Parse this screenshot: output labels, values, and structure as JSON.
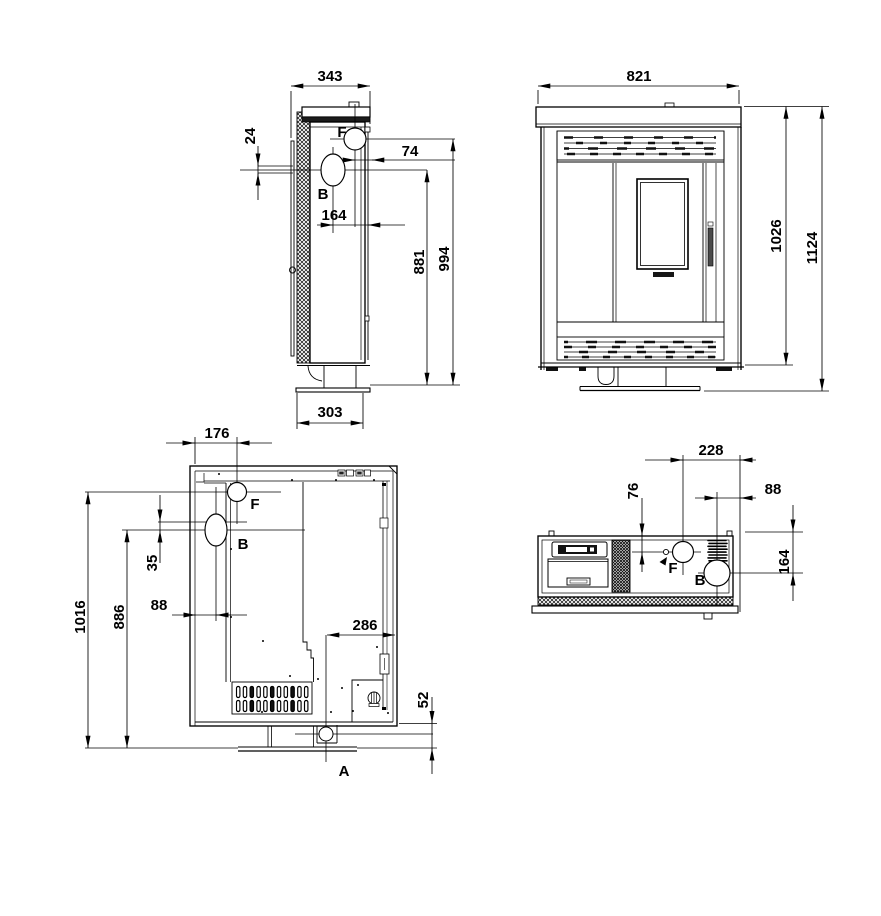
{
  "drawing": {
    "type": "stove-dimension-drawing",
    "views": {
      "side": {
        "dims": {
          "depth": "343",
          "back_offset": "24",
          "f_to_front": "74",
          "b_to_front": "164",
          "b_height": "881",
          "f_height": "994",
          "base_depth": "303"
        },
        "ports": {
          "f": "F",
          "b": "B"
        }
      },
      "front": {
        "dims": {
          "width": "821",
          "body_height": "1026",
          "total_height": "1124"
        }
      },
      "section": {
        "dims": {
          "f_offset": "176",
          "fb_gap": "35",
          "b_offset": "88",
          "f_height": "1016",
          "b_height": "886",
          "a_offset": "286",
          "a_height": "52"
        },
        "ports": {
          "f": "F",
          "b": "B",
          "a": "A"
        }
      },
      "top": {
        "dims": {
          "f_to_back": "228",
          "b_to_back": "88",
          "f_depth": "76",
          "b_depth": "164"
        },
        "ports": {
          "f": "F",
          "b": "B"
        }
      }
    },
    "colors": {
      "line": "#000000",
      "background": "#ffffff",
      "latch": "#4a4a4a",
      "dark_fill": "#161616"
    }
  }
}
